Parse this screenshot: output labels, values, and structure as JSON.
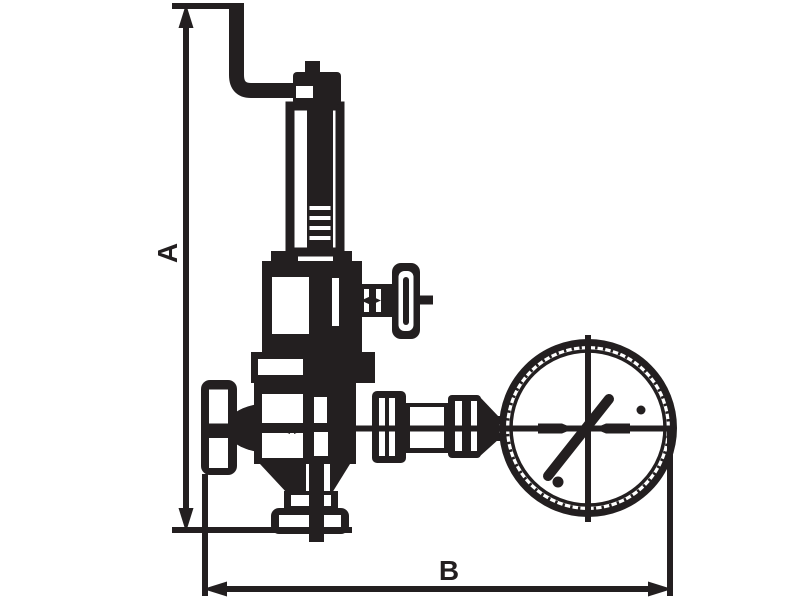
{
  "diagram": {
    "type": "technical-dimension-drawing",
    "subject": "pressure reducing valve with pressure gauge, outline drawing with overall dimensions",
    "ink": "#231f20",
    "background": "#ffffff",
    "labels": {
      "height_dimension": "A",
      "width_dimension": "B"
    },
    "parts": [
      "lever-pipe",
      "adjusting-cap",
      "spring-column",
      "spring-chamber",
      "side-tee-handle",
      "bonnet-flange",
      "inlet-handwheel",
      "valve-body",
      "bottom-outlet-union",
      "gauge-connection-piping",
      "pressure-gauge"
    ]
  }
}
